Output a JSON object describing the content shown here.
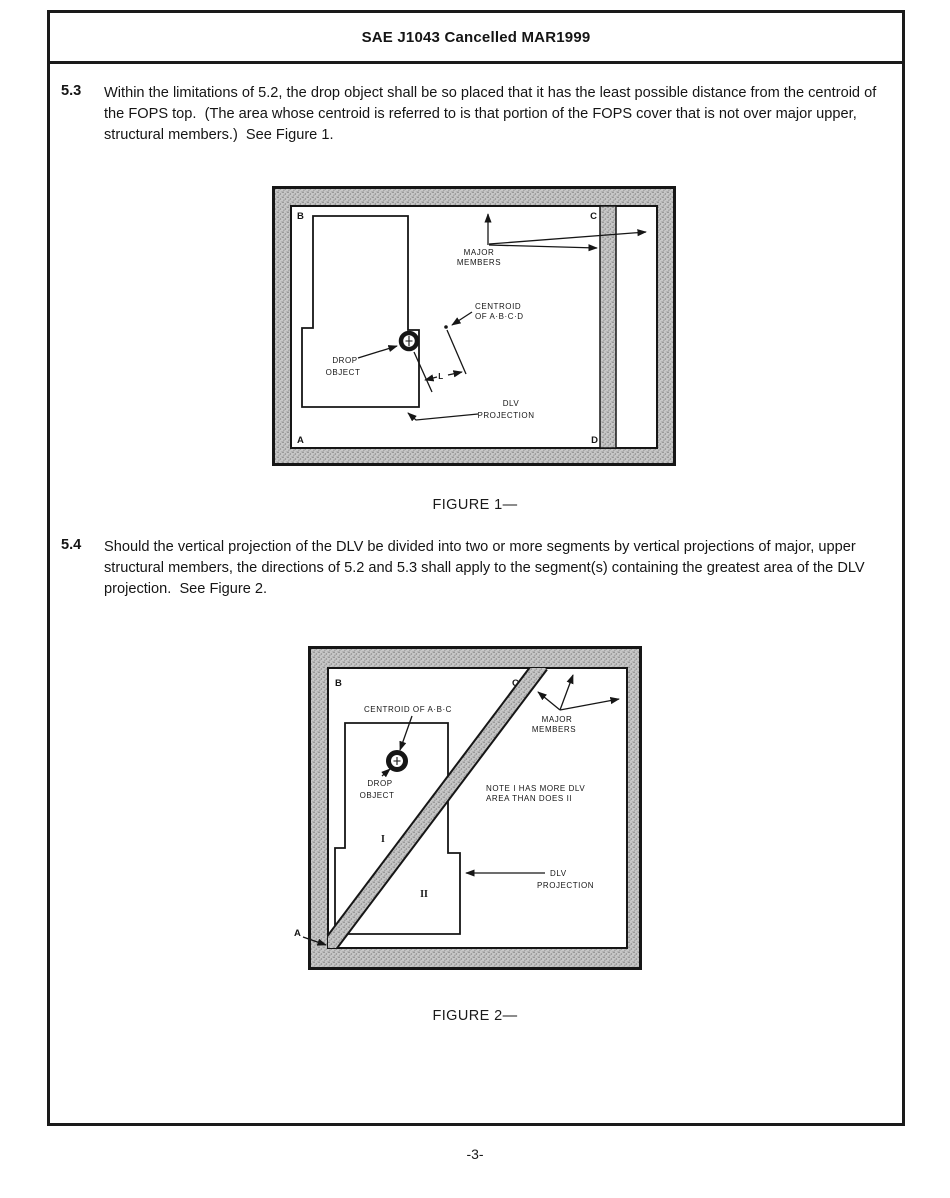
{
  "header": {
    "title": "SAE J1043 Cancelled MAR1999"
  },
  "sections": [
    {
      "number": "5.3",
      "text": "Within the limitations of 5.2, the drop object shall be so placed that it has the least possible distance from the centroid of the FOPS top.  (The area whose centroid is referred to is that portion of the FOPS cover that is not over major upper, structural members.)  See Figure 1."
    },
    {
      "number": "5.4",
      "text": "Should the vertical projection of the DLV be divided into two or more segments by vertical projections of major, upper structural members, the directions of 5.2 and 5.3 shall apply to the segment(s) containing the greatest area of the DLV projection.  See Figure 2."
    }
  ],
  "figure1": {
    "caption": "FIGURE 1—",
    "corner_b": "B",
    "corner_c": "C",
    "corner_a": "A",
    "corner_d": "D",
    "major_members_1": "MAJOR",
    "major_members_2": "MEMBERS",
    "centroid_1": "CENTROID",
    "centroid_2": "OF A·B·C·D",
    "drop_object_1": "DROP",
    "drop_object_2": "OBJECT",
    "dim_l": "L",
    "dlv_1": "DLV",
    "dlv_2": "PROJECTION"
  },
  "figure2": {
    "caption": "FIGURE 2—",
    "corner_b": "B",
    "corner_c": "C",
    "corner_a": "A",
    "centroid": "CENTROID OF A·B·C",
    "drop_object_1": "DROP",
    "drop_object_2": "OBJECT",
    "major_members_1": "MAJOR",
    "major_members_2": "MEMBERS",
    "note_1": "NOTE I HAS MORE DLV",
    "note_2": "AREA THAN DOES II",
    "segment_1": "I",
    "segment_2": "II",
    "dlv_1": "DLV",
    "dlv_2": "PROJECTION"
  },
  "page": {
    "number": "-3-"
  },
  "colors": {
    "ink": "#161616",
    "stipple_bg": "#c7c7c7",
    "paper": "#ffffff"
  }
}
